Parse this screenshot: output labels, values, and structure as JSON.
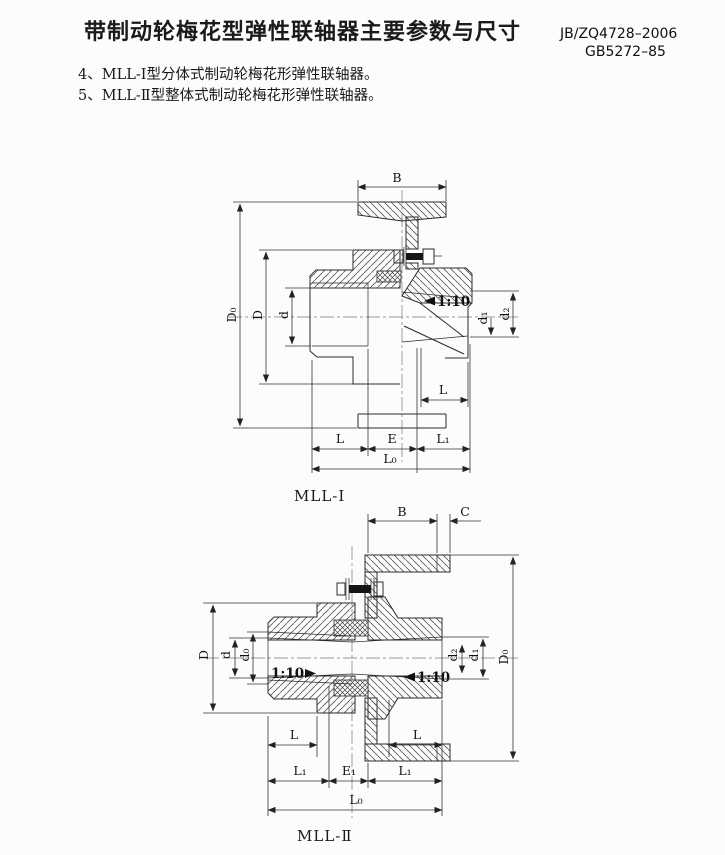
{
  "page": {
    "title": "带制动轮梅花型弹性联轴器主要参数与尺寸",
    "standard_codes": [
      "JB/ZQ4728–2006",
      "GB5272–85"
    ],
    "notes": [
      "4、MLL-Ⅰ型分体式制动轮梅花形弹性联轴器。",
      "5、MLL-Ⅱ型整体式制动轮梅花形弹性联轴器。"
    ]
  },
  "figure1": {
    "caption": "MLL-Ⅰ",
    "dims": {
      "B": "B",
      "D0": "D₀",
      "D": "D",
      "d": "d",
      "taper": "1:10",
      "d1": "d₁",
      "d2": "d₂",
      "L_shaft": "L",
      "L": "L",
      "E": "E",
      "L1": "L₁",
      "L0": "L₀"
    }
  },
  "figure2": {
    "caption": "MLL-Ⅱ",
    "dims": {
      "B": "B",
      "C": "C",
      "D": "D",
      "d": "d",
      "d0": "d₀",
      "taper_left": "1:10",
      "taper_right": "1:10",
      "d2": "d₂",
      "d1": "d₁",
      "D0": "D₀",
      "L_left": "L",
      "L_right": "L",
      "L1_left": "L₁",
      "E1": "E₁",
      "L1_right": "L₁",
      "L0": "L₀"
    }
  }
}
